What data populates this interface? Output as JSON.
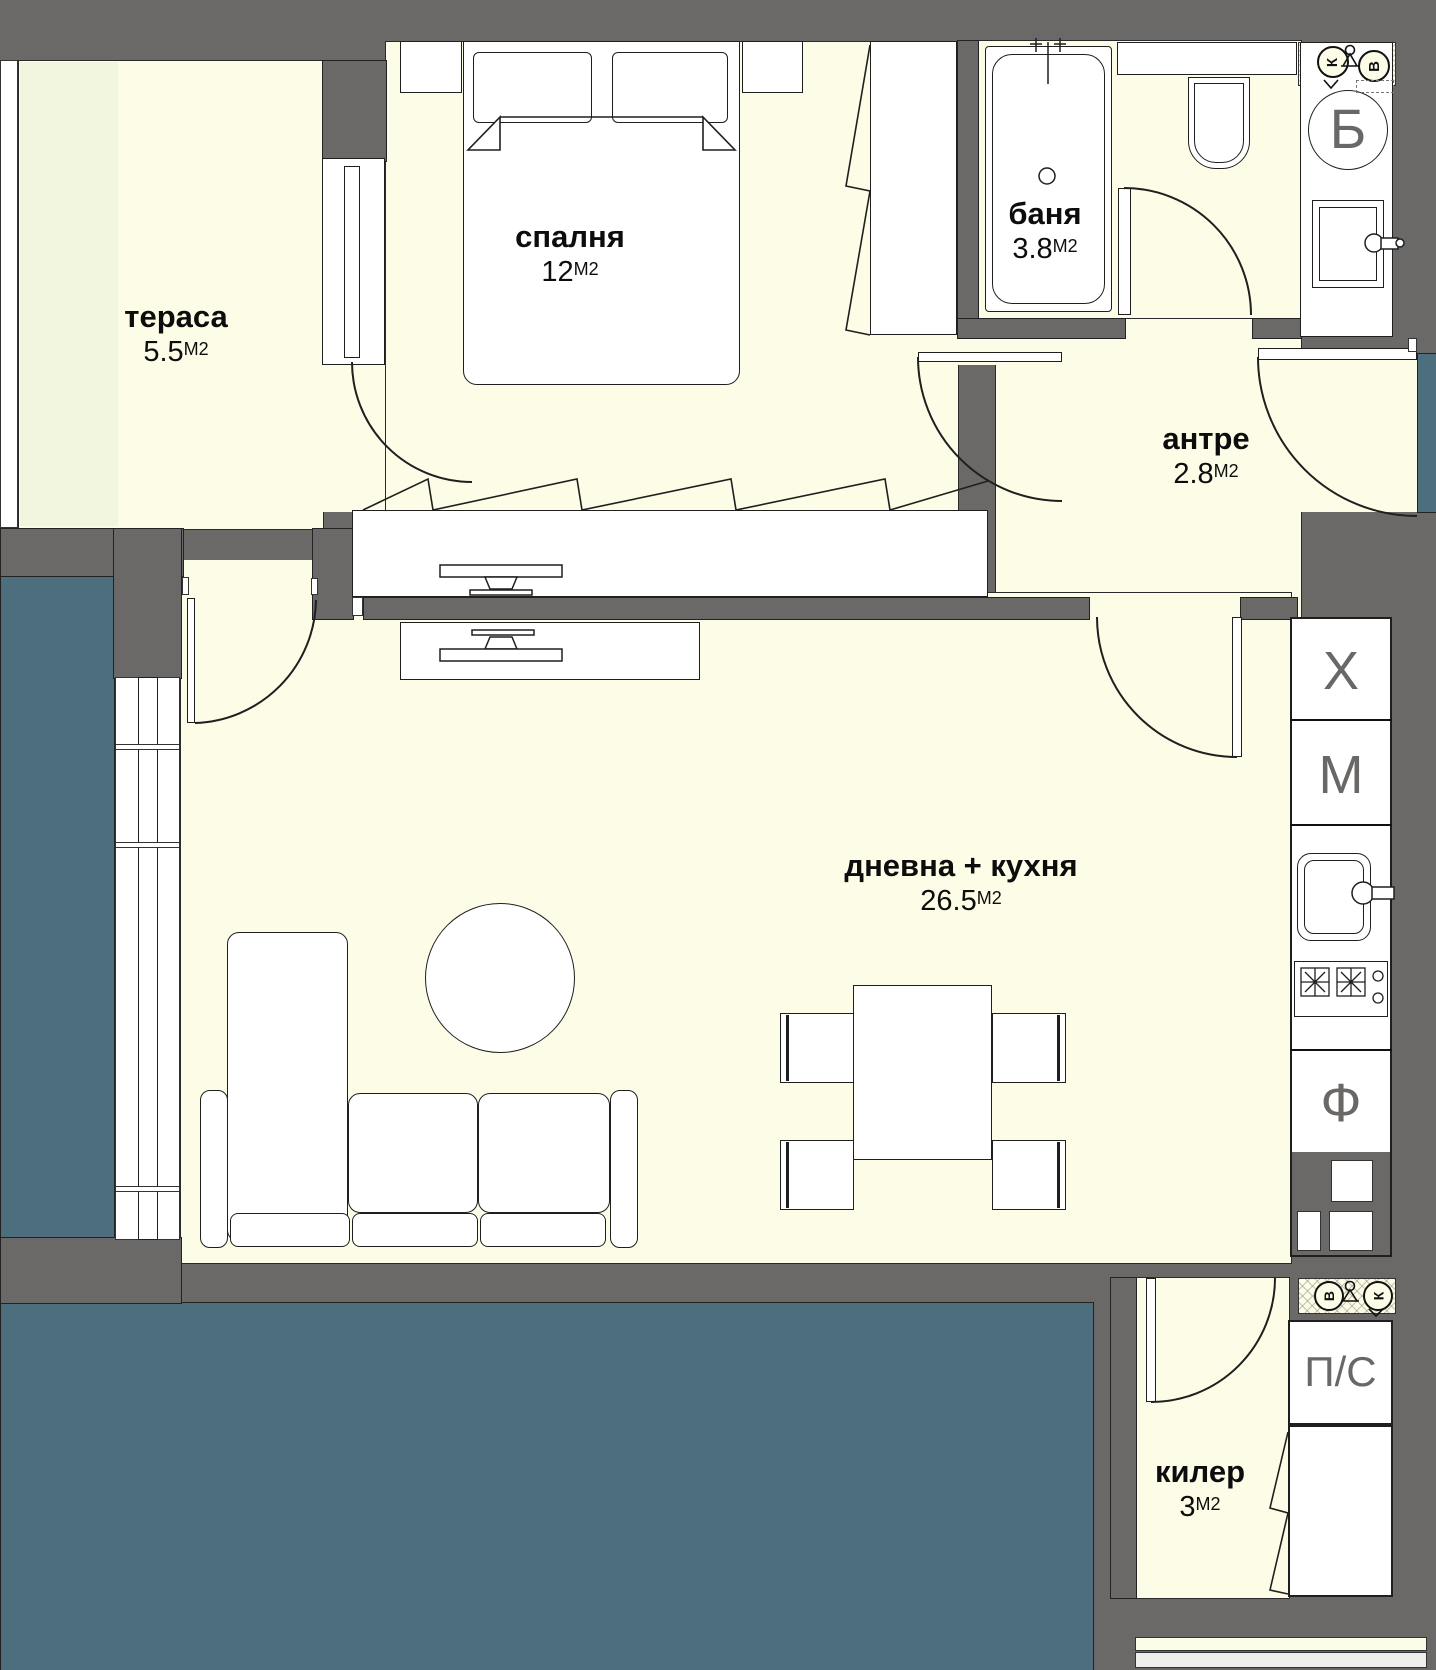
{
  "plan": {
    "rooms": {
      "terrace": {
        "name": "тераса",
        "area": "5.5",
        "unit": "М2"
      },
      "bedroom": {
        "name": "спалня",
        "area": "12",
        "unit": "М2"
      },
      "bathroom": {
        "name": "баня",
        "area": "3.8",
        "unit": "М2"
      },
      "hall": {
        "name": "антре",
        "area": "2.8",
        "unit": "М2"
      },
      "living": {
        "name": "дневна + кухня",
        "area": "26.5",
        "unit": "М2"
      },
      "pantry": {
        "name": "килер",
        "area": "3",
        "unit": "М2"
      }
    },
    "fixtures": {
      "fridge": "Х",
      "washing_machine": "М",
      "oven": "Ф",
      "washer_dryer": "П/С",
      "boiler": "Б"
    },
    "risers": {
      "water": "В",
      "sewer": "К"
    },
    "colors": {
      "wall": "#6b6968",
      "floor": "#fdfce6",
      "terrace_floor": "#f2f6de",
      "exterior": "#4d6e7c",
      "fixture_letters": "#6a6866"
    }
  }
}
